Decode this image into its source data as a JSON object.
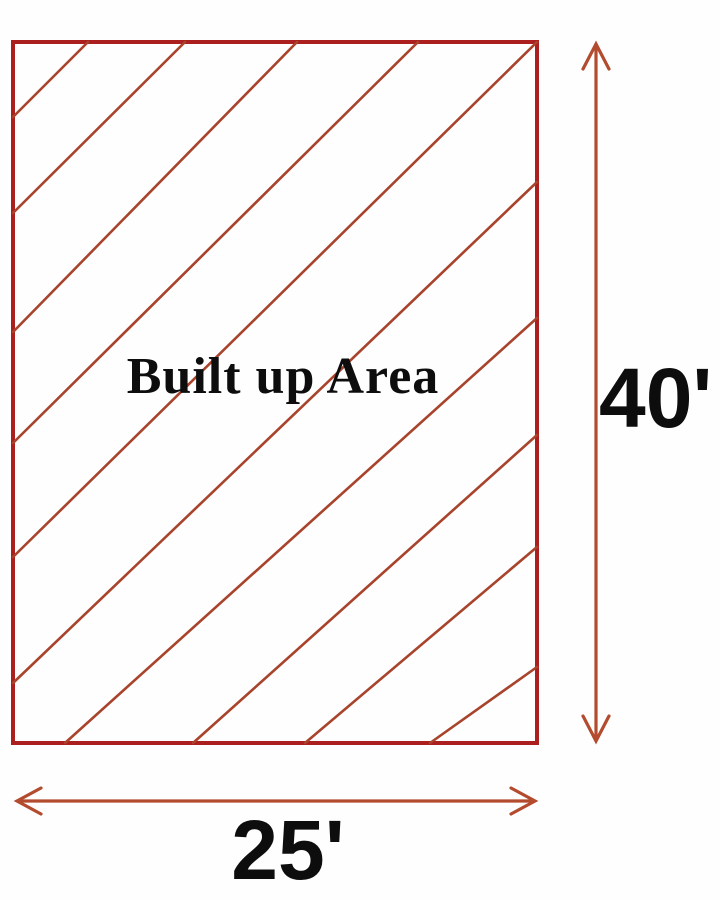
{
  "diagram": {
    "area_label": "Built up Area",
    "height_dimension": "40'",
    "width_dimension": "25'"
  },
  "colors": {
    "rect_border": "#ab1f1e",
    "hatch_line": "#a8432c",
    "arrow": "#b34b2e",
    "label_text": "#0d0d0d",
    "page_bg": "#fefefe"
  }
}
